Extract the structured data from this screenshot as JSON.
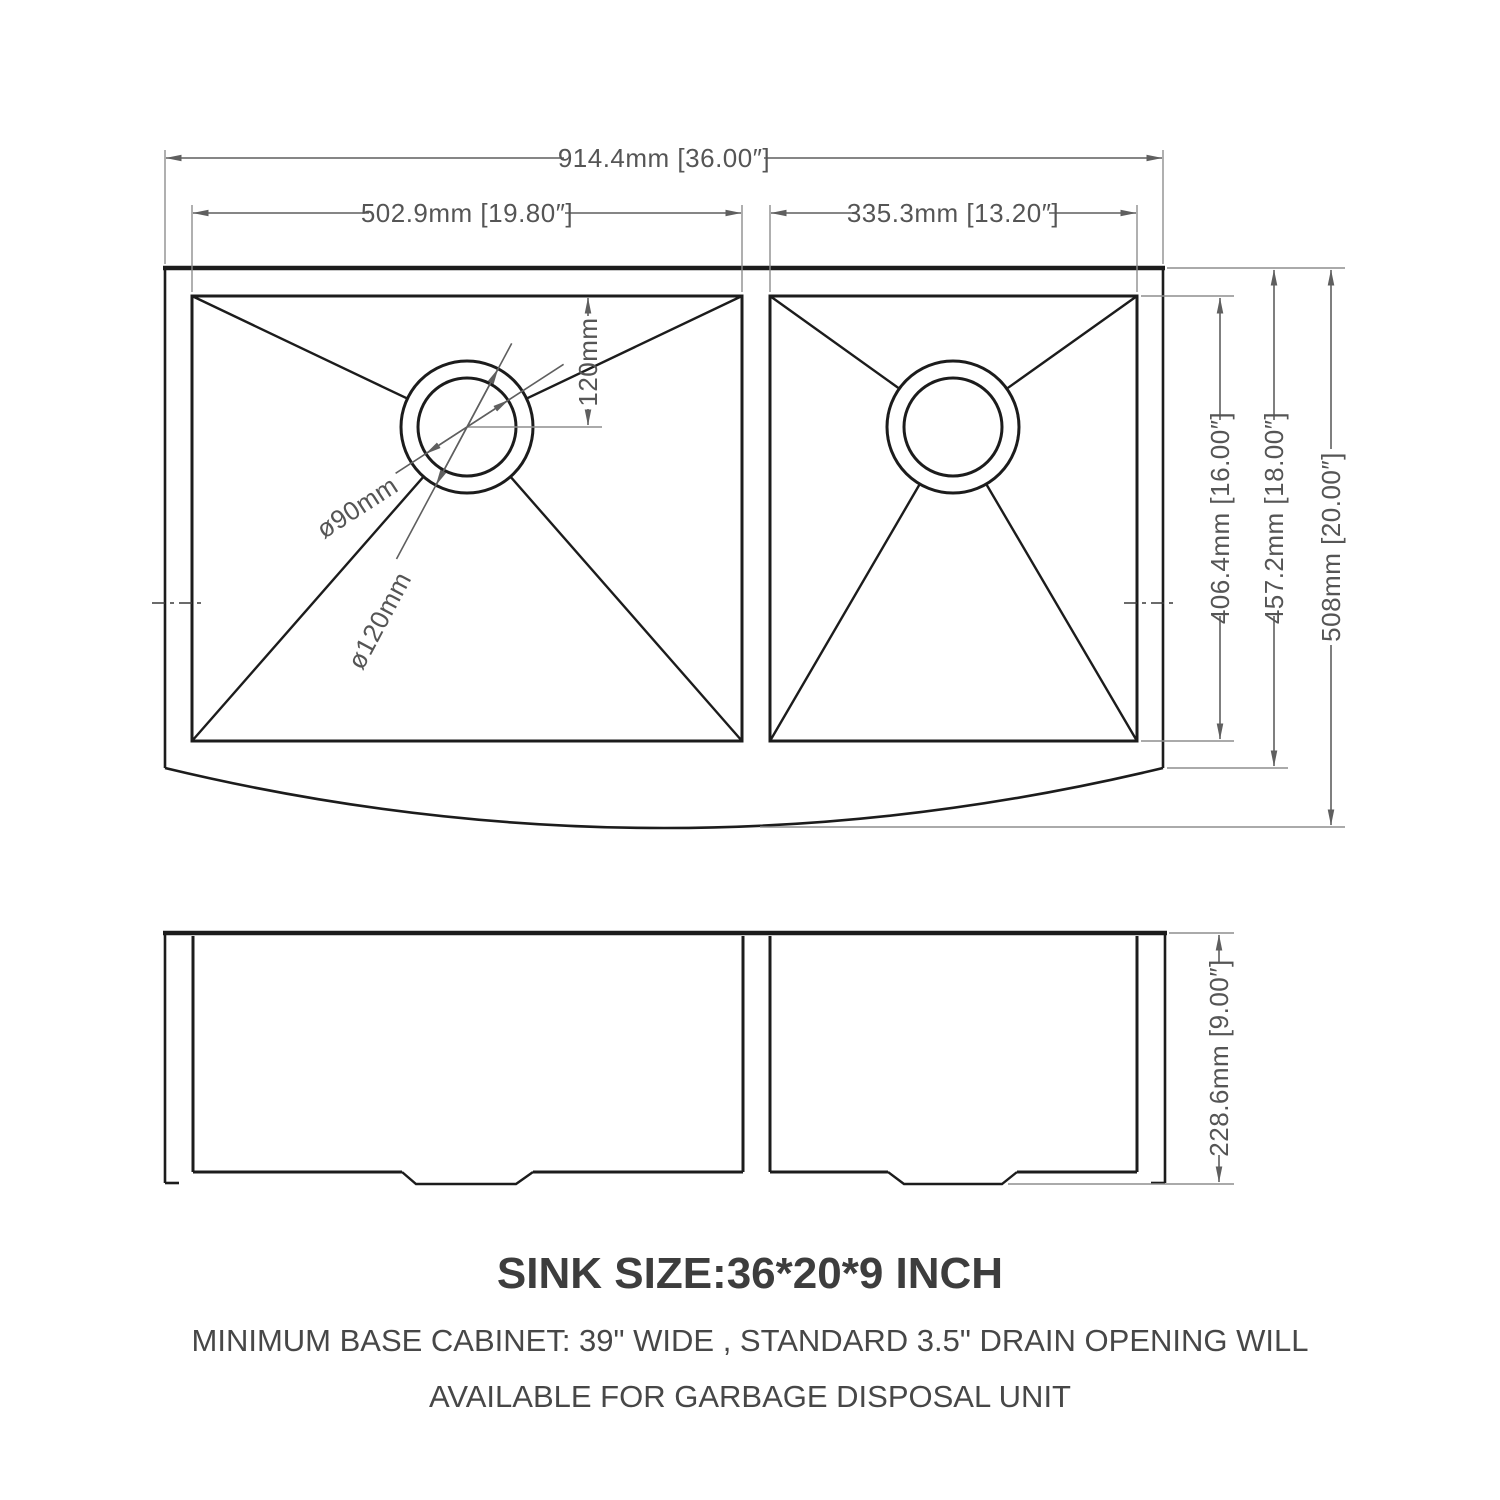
{
  "drawing": {
    "title": "Farmhouse double bowl sink dimension drawing",
    "colors": {
      "background": "#ffffff",
      "outline": "#1c1c1c",
      "dimension": "#555555",
      "extension": "#8d8d8d",
      "note_text": "#3d3d3d"
    },
    "top_view": {
      "overall_width": "914.4mm [36.00″]",
      "left_bowl_width": "502.9mm [19.80″]",
      "right_bowl_width": "335.3mm [13.20″]",
      "drain_offset_from_back": "120mm",
      "drain_inner_diameter": "ø90mm",
      "drain_outer_diameter": "ø120mm",
      "bowl_front_to_back": "406.4mm [16.00″]",
      "body_front_to_back": "457.2mm [18.00″]",
      "overall_front_to_back": "508mm [20.00″]"
    },
    "front_view": {
      "overall_height": "228.6mm [9.00″]"
    },
    "notes": {
      "size_title": "SINK SIZE:36*20*9 INCH",
      "note_line_1": "MINIMUM BASE CABINET: 39\" WIDE , STANDARD 3.5\" DRAIN OPENING WILL",
      "note_line_2": "AVAILABLE FOR GARBAGE DISPOSAL UNIT"
    }
  }
}
